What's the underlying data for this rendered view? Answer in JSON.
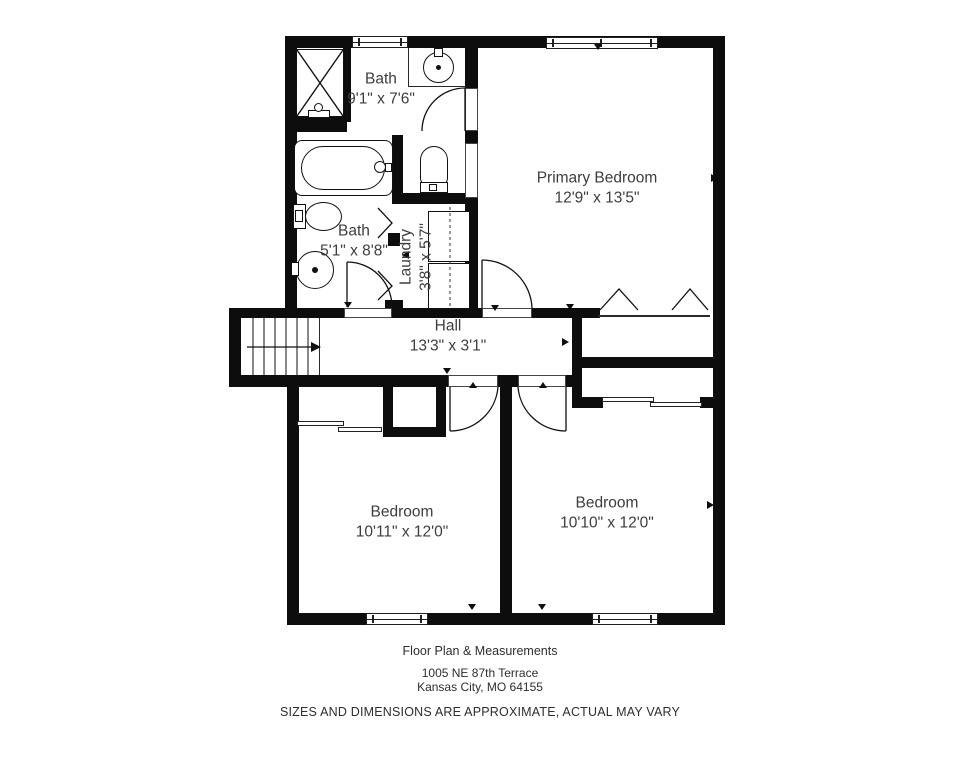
{
  "plan": {
    "rooms": {
      "bath_ensuite": {
        "name": "Bath",
        "dims": "9'1\" x 7'6\""
      },
      "primary_bedroom": {
        "name": "Primary Bedroom",
        "dims": "12'9\" x 13'5\""
      },
      "bath_hall": {
        "name": "Bath",
        "dims": "5'1\" x 8'8\""
      },
      "laundry": {
        "name": "Laundry",
        "dims": "3'8\" x 5'7\""
      },
      "hall": {
        "name": "Hall",
        "dims": "13'3\" x 3'1\""
      },
      "bedroom_left": {
        "name": "Bedroom",
        "dims": "10'11\" x 12'0\""
      },
      "bedroom_right": {
        "name": "Bedroom",
        "dims": "10'10\" x 12'0\""
      }
    },
    "fixtures": [
      "shower",
      "vanity-sink",
      "toilet",
      "bathtub",
      "toilet",
      "pedestal-sink",
      "washer-dryer",
      "stairs"
    ],
    "colors": {
      "wall": "#0d0d0d",
      "label_text": "#3d3d3d",
      "background": "#ffffff"
    }
  },
  "footer": {
    "title": "Floor Plan & Measurements",
    "address_line1": "1005 NE 87th Terrace",
    "address_line2": "Kansas City, MO 64155",
    "disclaimer": "SIZES AND DIMENSIONS ARE APPROXIMATE, ACTUAL MAY VARY"
  }
}
